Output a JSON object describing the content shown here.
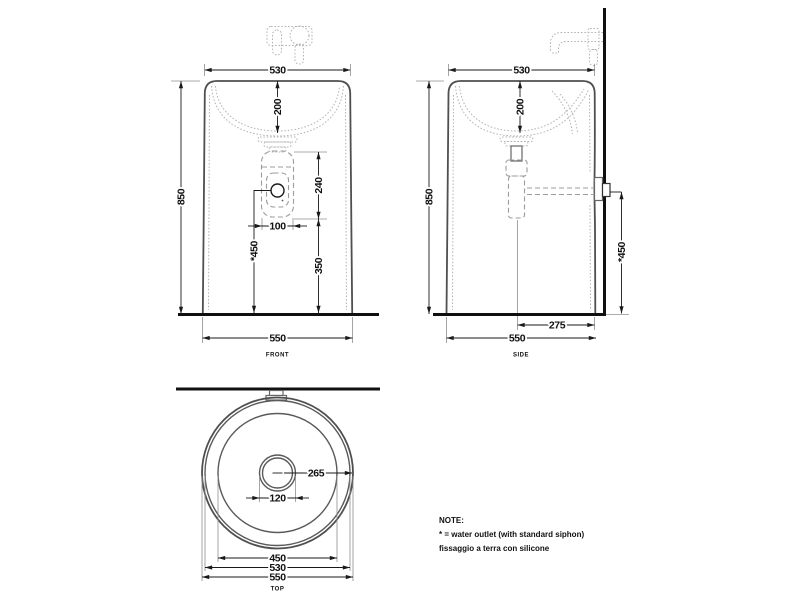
{
  "page": {
    "background": "#ffffff",
    "line_color": "#1a1a1a",
    "outline_color": "#4f4f4f",
    "detail_color": "#b4b4b4"
  },
  "views": {
    "front": {
      "label": "FRONT",
      "dim_top_width": "530",
      "dim_bowl_depth": "200",
      "dim_height": "850",
      "dim_siphon_height": "240",
      "dim_outlet_offset": "100",
      "dim_outlet_height": "*450",
      "dim_drain_floor": "350",
      "dim_base_width": "550"
    },
    "side": {
      "label": "SIDE",
      "dim_top_width": "530",
      "dim_bowl_depth": "200",
      "dim_height": "850",
      "dim_outlet_height": "*450",
      "dim_outlet_wall": "275",
      "dim_base_width": "550"
    },
    "top": {
      "label": "TOP",
      "dim_center_to_edge": "265",
      "dim_drain": "120",
      "dim_bowl": "450",
      "dim_rim": "530",
      "dim_outer": "550"
    }
  },
  "note": {
    "title": "NOTE:",
    "lines": [
      "* = water outlet (with standard siphon)",
      "fissaggio a terra con silicone"
    ]
  }
}
